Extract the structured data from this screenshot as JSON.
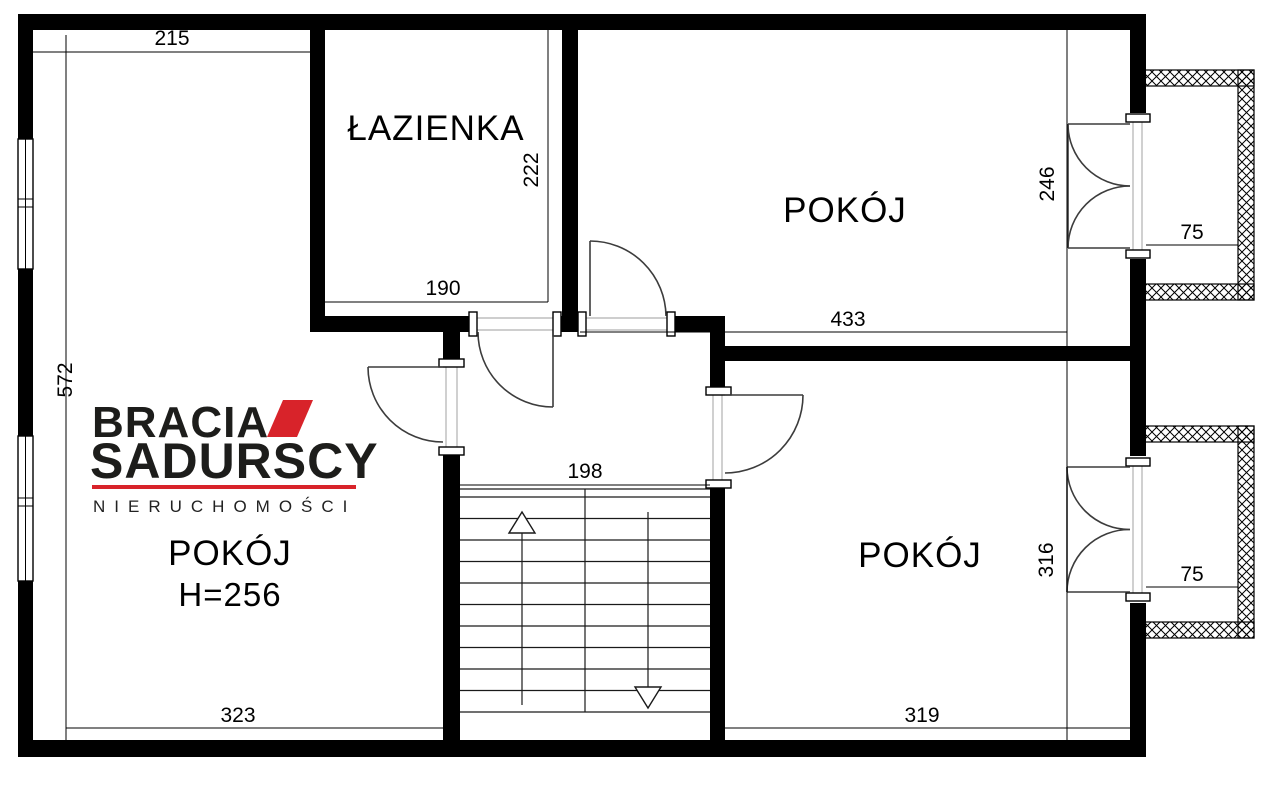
{
  "brand": {
    "line1": "BRACIA",
    "line2": "SADURSCY",
    "line3": "NIERUCHOMOŚCI",
    "red": "#d8232a"
  },
  "rooms": {
    "left": {
      "label": "POKÓJ",
      "height_note": "H=256"
    },
    "bathroom": {
      "label": "ŁAZIENKA"
    },
    "top_right": {
      "label": "POKÓJ"
    },
    "bottom_right": {
      "label": "POKÓJ"
    }
  },
  "dimensions": {
    "top_left_width": "215",
    "left_height": "572",
    "bathroom_width": "190",
    "bathroom_height": "222",
    "top_right_width": "433",
    "top_right_height": "246",
    "top_balcony_width": "75",
    "stairs_width": "198",
    "bottom_right_height": "316",
    "bottom_balcony_width": "75",
    "bottom_left_width": "323",
    "bottom_right_width": "319"
  }
}
